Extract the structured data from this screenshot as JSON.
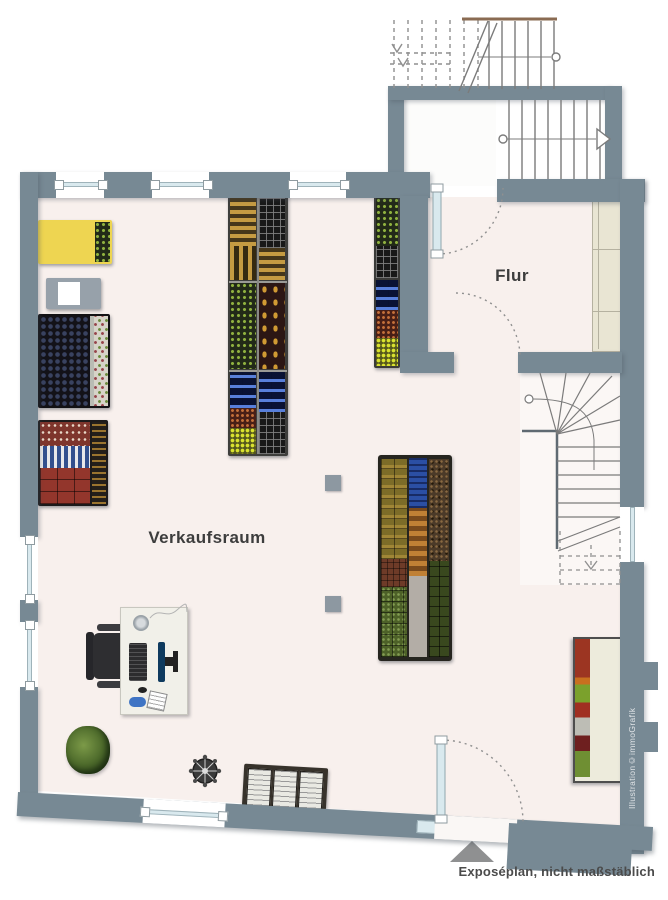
{
  "labels": {
    "room_main": "Verkaufsraum",
    "room_hall": "Flur",
    "footer_note": "Exposéplan, nicht maßstäblich",
    "watermark": "Illustration©immoGrafik"
  },
  "colors": {
    "wall": "#778994",
    "floor": "#f8f0ed",
    "glass": "#d9e9ee",
    "stair_line": "#7b7b7b",
    "label_text": "#3d3d3d",
    "note_text": "#4b4b4b"
  }
}
